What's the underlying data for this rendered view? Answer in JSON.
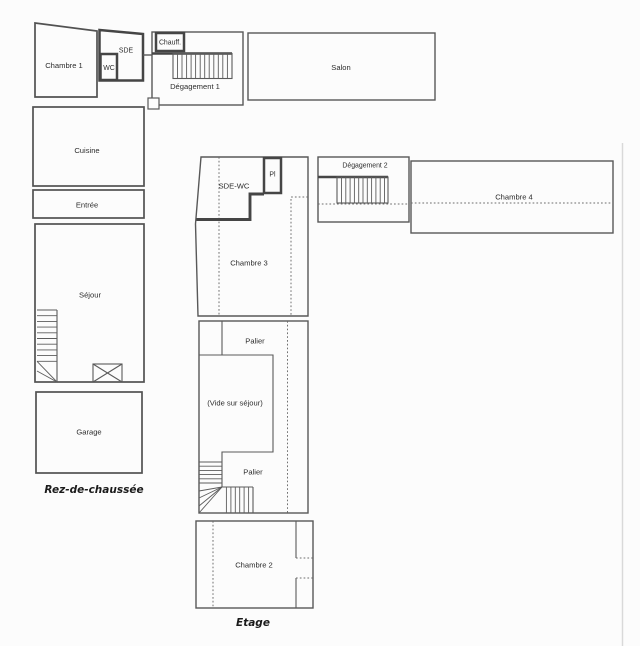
{
  "plan": {
    "ground": {
      "title": "Rez-de-chaussée",
      "rooms": {
        "chambre1": "Chambre 1",
        "sde": "SDE",
        "wc": "WC",
        "chauff": "Chauff.",
        "degagement1": "Dégagement 1",
        "salon": "Salon",
        "cuisine": "Cuisine",
        "entree": "Entrée",
        "sejour": "Séjour",
        "garage": "Garage"
      }
    },
    "upper": {
      "title": "Etage",
      "rooms": {
        "sde_wc": "SDE-WC",
        "pl": "Pl",
        "chambre3": "Chambre 3",
        "palier_top": "Palier",
        "vide": "(Vide sur séjour)",
        "palier_bottom": "Palier",
        "chambre2": "Chambre 2",
        "degagement2": "Dégagement 2",
        "chambre4": "Chambre 4"
      }
    },
    "colors": {
      "background": "#fcfcfc",
      "wall": "#585858",
      "wall_thick": "#454545",
      "label_text": "#2d2d2d",
      "page_edge": "#d9d9d9"
    }
  }
}
